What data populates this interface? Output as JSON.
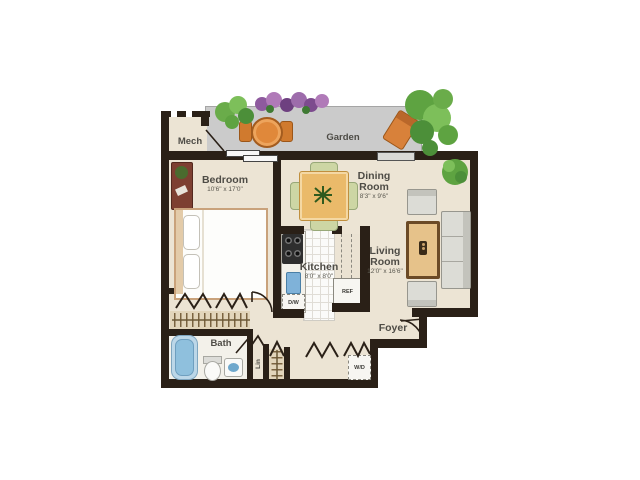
{
  "rooms": [
    {
      "id": "bedroom",
      "label_lines": [
        "Bedroom"
      ],
      "dims": "10'6\" x 17'0\""
    },
    {
      "id": "dining",
      "label_lines": [
        "Dining",
        "Room"
      ],
      "dims": "8'3\" x 9'6\""
    },
    {
      "id": "kitchen",
      "label_lines": [
        "Kitchen"
      ],
      "dims": "8'0\" x 8'0\""
    },
    {
      "id": "living",
      "label_lines": [
        "Living",
        "Room"
      ],
      "dims": "12'0\" x 16'6\""
    }
  ],
  "labels": {
    "garden": "Garden",
    "mech": "Mech",
    "foyer": "Foyer",
    "bath": "Bath",
    "linen": "Lin"
  },
  "appliances": {
    "dishwasher": "D/W",
    "refrigerator": "REF",
    "washer_dryer": "W/D"
  },
  "colors": {
    "wall": "#2a2017",
    "floor": "#ece4d4",
    "patio": "#cbcbcb",
    "water": "#7fb3d4",
    "table_wood": "#eaba6a",
    "upholstery": "#dcdcd6",
    "greenery": "#5ea341",
    "flowers": "#8e5a9e",
    "garden_furniture": "#d8813a"
  }
}
